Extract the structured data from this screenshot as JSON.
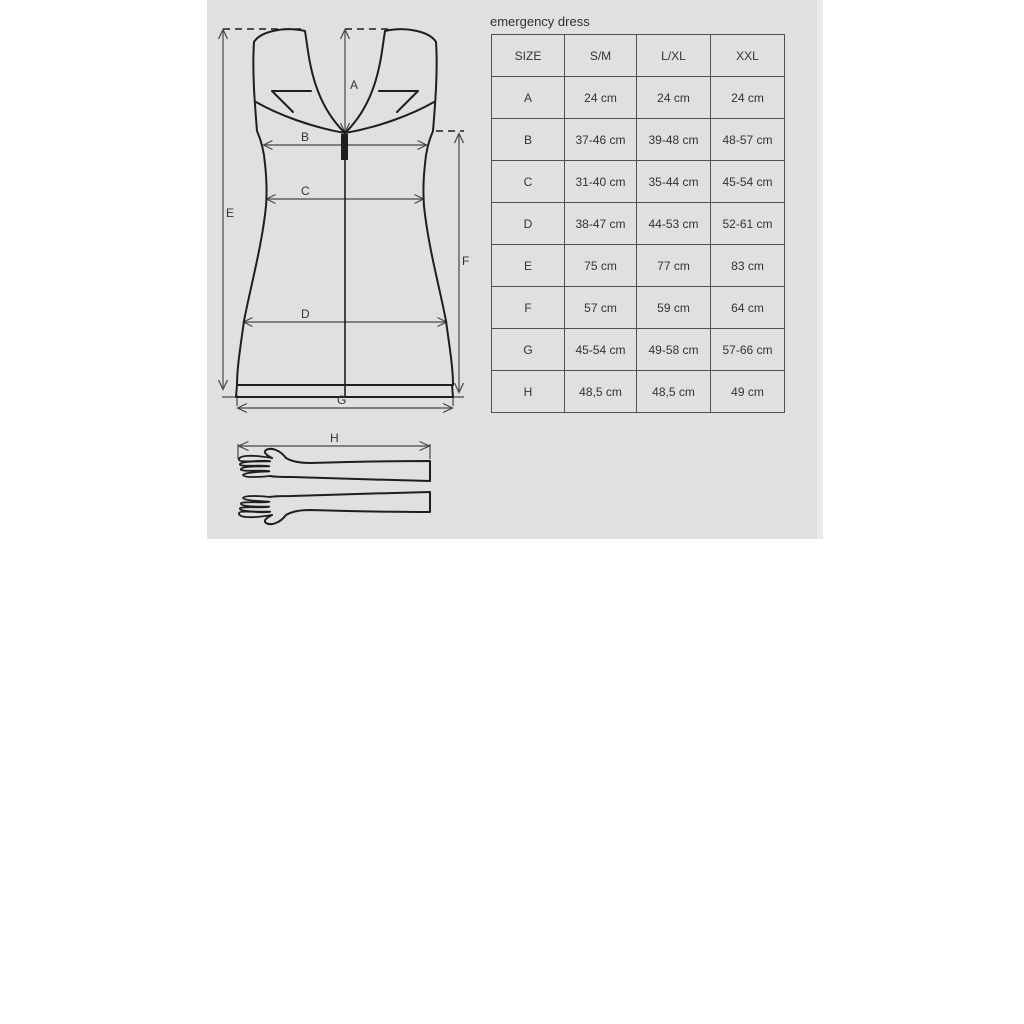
{
  "title": "emergency dress",
  "table": {
    "columns": [
      "SIZE",
      "S/M",
      "L/XL",
      "XXL"
    ],
    "rows": [
      [
        "A",
        "24 cm",
        "24 cm",
        "24 cm"
      ],
      [
        "B",
        "37-46 cm",
        "39-48 cm",
        "48-57 cm"
      ],
      [
        "C",
        "31-40 cm",
        "35-44 cm",
        "45-54 cm"
      ],
      [
        "D",
        "38-47 cm",
        "44-53 cm",
        "52-61 cm"
      ],
      [
        "E",
        "75 cm",
        "77 cm",
        "83 cm"
      ],
      [
        "F",
        "57 cm",
        "59 cm",
        "64 cm"
      ],
      [
        "G",
        "45-54 cm",
        "49-58 cm",
        "57-66 cm"
      ],
      [
        "H",
        "48,5 cm",
        "48,5 cm",
        "49 cm"
      ]
    ]
  },
  "diagram": {
    "dimension_labels": {
      "A": "A",
      "B": "B",
      "C": "C",
      "D": "D",
      "E": "E",
      "F": "F",
      "G": "G",
      "H": "H"
    }
  },
  "colors": {
    "panel_bg": "#e0e0de",
    "outline": "#1e1e1e",
    "dimension": "#474747",
    "text": "#333333"
  }
}
